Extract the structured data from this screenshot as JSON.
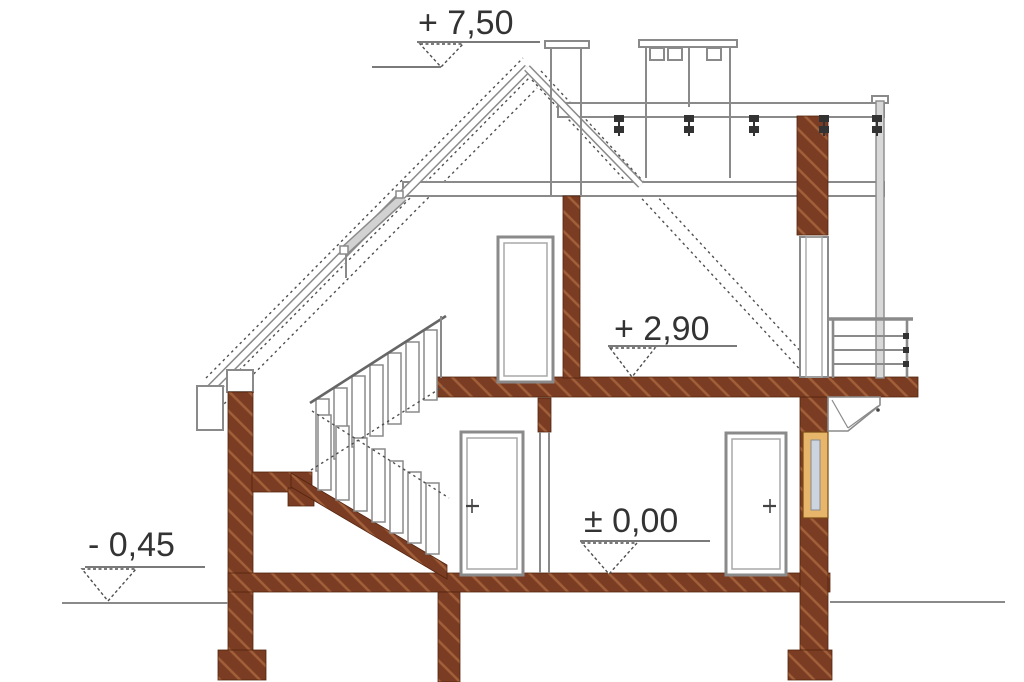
{
  "drawing": {
    "type": "architectural-cross-section",
    "labels": {
      "ridge": "+ 7,50",
      "attic_floor": "+ 2,90",
      "ground_floor": "± 0,00",
      "grade": "- 0,45"
    },
    "icons": {
      "elevation_marker": "down-pointing open triangle on level line"
    },
    "colors": {
      "wood": "#7a3c22",
      "wood_light": "#a2603a",
      "wood_dark": "#55250f",
      "line": "#8a8a8a",
      "line_dark": "#4f4f4f",
      "text": "#333333",
      "window_frame": "#e7b66b",
      "window_frame_dark": "#7a4a14",
      "glass": "#ccd4e0"
    }
  }
}
